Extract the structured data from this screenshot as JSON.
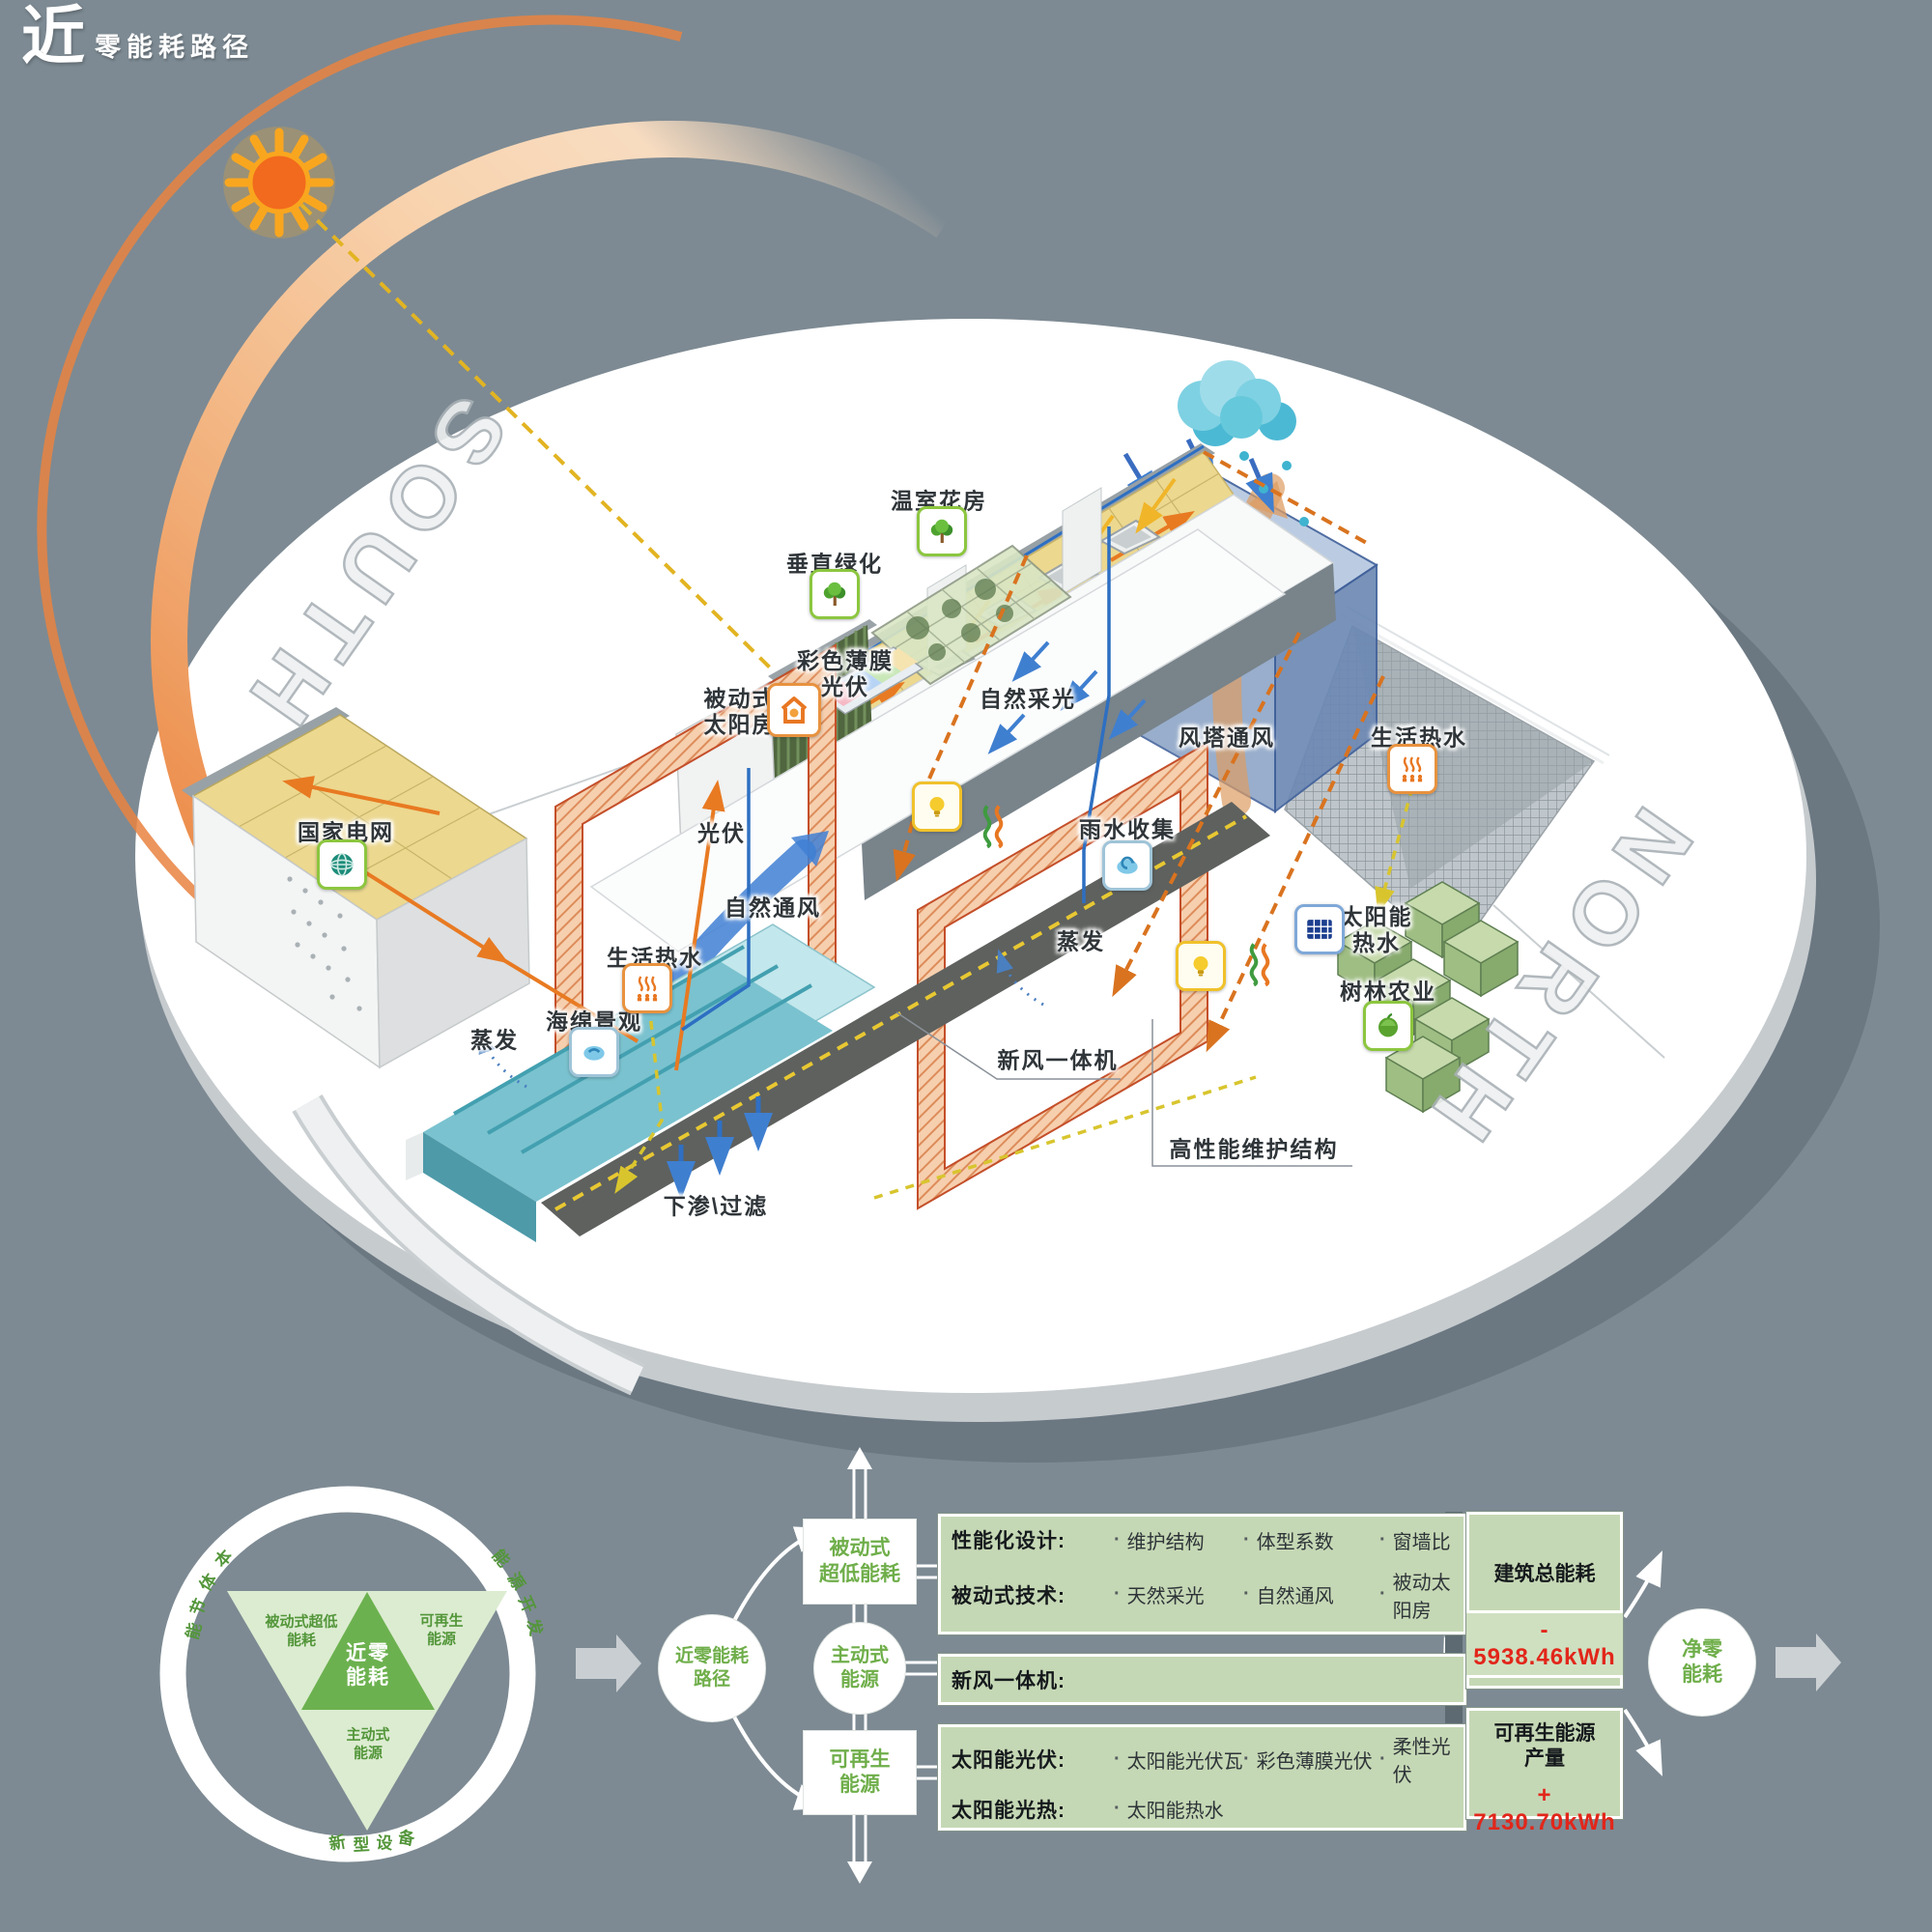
{
  "header": {
    "title_big": "近",
    "title_rest": "零能耗路径"
  },
  "compass": {
    "south": "SOUTH",
    "north": "NORTH"
  },
  "scene": {
    "labels": {
      "greenhouse": "温室花房",
      "vertical_greening": "垂直绿化",
      "color_film_pv": "彩色薄膜\n光伏",
      "passive_solar_house": "被动式\n太阳房",
      "daylighting": "自然采光",
      "wind_tower": "风塔通风",
      "dhw_right": "生活热水",
      "rain_collect": "雨水收集",
      "evaporation_center": "蒸发",
      "solar_hot_water": "太阳能\n热水",
      "forest_agri": "树林农业",
      "state_grid": "国家电网",
      "pv": "光伏",
      "natural_vent": "自然通风",
      "dhw_left": "生活热水",
      "sponge": "海绵景观",
      "evaporation_left": "蒸发",
      "ahu": "新风一体机",
      "envelope": "高性能维护结构",
      "infiltration": "下渗\\过滤"
    }
  },
  "flow": {
    "bullet": "·",
    "cycle": {
      "ring_top_left": {
        "chars": [
          "本",
          "体",
          "节",
          "能"
        ]
      },
      "ring_top_right": {
        "chars": [
          "能",
          "源",
          "开",
          "发"
        ]
      },
      "ring_bottom": {
        "chars": [
          "新",
          "型",
          "设",
          "备"
        ]
      },
      "passive": "被动式超低\n能耗",
      "renewable": "可再生\n能源",
      "active": "主动式\n能源",
      "center": "近零\n能耗"
    },
    "path_circle": "近零能耗\n路径",
    "stages": {
      "passive": "被动式\n超低能耗",
      "active": "主动式\n能源",
      "renewable": "可再生\n能源"
    },
    "panels": [
      {
        "rows": [
          {
            "label": "性能化设计:",
            "items": [
              "维护结构",
              "体型系数",
              "窗墙比"
            ]
          },
          {
            "label": "被动式技术:",
            "items": [
              "天然采光",
              "自然通风",
              "被动太阳房"
            ]
          }
        ]
      },
      {
        "rows": [
          {
            "label": "新风一体机:",
            "items": []
          }
        ]
      },
      {
        "rows": [
          {
            "label": "太阳能光伏:",
            "items": [
              "太阳能光伏瓦",
              "彩色薄膜光伏",
              "柔性光伏"
            ]
          },
          {
            "label": "太阳能光热:",
            "items": [
              "太阳能热水"
            ]
          }
        ]
      }
    ],
    "results": [
      {
        "title": "建筑总能耗",
        "value": "- 5938.46kWh"
      },
      {
        "title": "可再生能源\n产量",
        "value": "+ 7130.70kWh"
      }
    ],
    "net_circle": "净零\n能耗"
  },
  "colors": {
    "background": "#7d8a93",
    "panel_green": "#c5d8b5",
    "diagram_green": "#6fae4a",
    "triangle_dark": "#6cb14f",
    "triangle_light": "#dcecd1",
    "value_red": "#e2261a",
    "accent_orange": "#e87a22",
    "sun_orange": "#f26a1d",
    "arc_peach": "#f6c9a2",
    "tower_blue": "#8aa3c6",
    "pond_teal": "#7ac2cf",
    "pv_roof_yellow": "#ecd88f"
  }
}
